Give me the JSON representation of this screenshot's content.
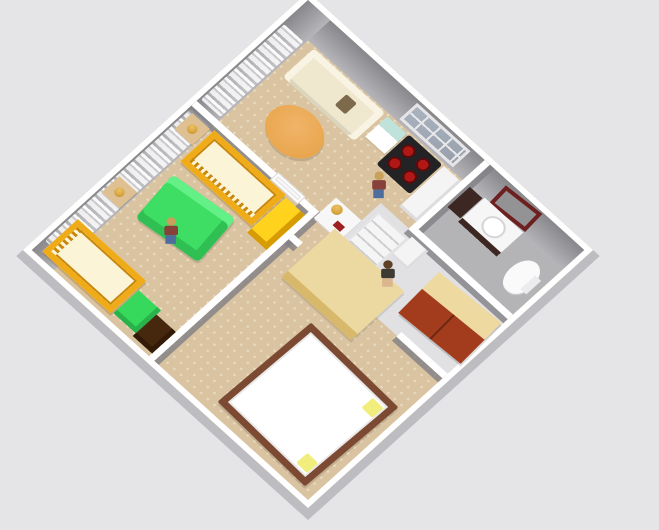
{
  "scene": {
    "type": "home-design-3d-aerial-view",
    "background_color": "#e5e4e6",
    "palette": {
      "bg": "#e5e4e6",
      "wall-white": "#ffffff",
      "wall-shadow": "#bdbcc0",
      "wall-face-dark": "#88888c",
      "wall-face-light": "#b6b6ba",
      "carpet": "#d9c3a1",
      "carpet-dot": "#e9dabd",
      "bath-floor": "#b4b4b7",
      "hall-floor": "#e1e1e3",
      "curtain-dim": "#c9c9ce",
      "window-pane": "#a9b2bf",
      "cream": "#efe8cf",
      "cream-light": "#f8f3e2",
      "cushion-brown": "#7d6a4c",
      "table-orange": "#e8a64d",
      "teal": "#bfe3da",
      "stove-black": "#232326",
      "burner-red": "#b01815",
      "counter-white": "#f4f4f5",
      "sink-dark": "#3c2723",
      "mirror-frame": "#6e2020",
      "mirror-glass": "#939396",
      "wardrobe-red": "#a23c1d",
      "wardrobe-top": "#eed9a0",
      "wardrobe-seam": "#6f2712",
      "shelf-line": "#cfcfd2",
      "crib-yellow": "#efac18",
      "crib-slat": "#c8860c",
      "mattress": "#fbf4d6",
      "dresser-yellow": "#ffd21e",
      "dresser-yellow-dark": "#d79c04",
      "sofa-green": "#3ede64",
      "sofa-green-dark": "#2fbf52",
      "sofa-green-light": "#63f087",
      "chest-green": "#36d95c",
      "dresser-brown": "#46280f",
      "bed-frame": "#7c4a33",
      "pillow-yellow": "#f2ee7d",
      "wood-light": "#ecd9a1",
      "wood-edge": "#d8b86a",
      "desk-white": "#f7f7f8",
      "book-red": "#9e2020",
      "lamp-gold": "#d8a43c",
      "skin": "#d9b68c",
      "hair-blond": "#c9a05c",
      "hair-brown": "#5f3f26",
      "shirt-maroon": "#87413a",
      "jeans": "#4d6d9e",
      "dress-dark": "#3d3b33"
    },
    "rooms": [
      {
        "id": "living-room",
        "floor": "beige-carpet"
      },
      {
        "id": "kitchen",
        "floor": "beige-carpet"
      },
      {
        "id": "bathroom",
        "floor": "gray-tile"
      },
      {
        "id": "hallway",
        "floor": "white-tile"
      },
      {
        "id": "nursery",
        "floor": "beige-carpet"
      },
      {
        "id": "bedroom",
        "floor": "beige-carpet"
      }
    ],
    "structure": [
      {
        "id": "outer-walls",
        "color": "#ffffff"
      },
      {
        "id": "curtains-living-wall",
        "color": "#ffffff"
      },
      {
        "id": "curtains-nursery-wall",
        "color": "#ffffff"
      },
      {
        "id": "kitchen-window",
        "pane_color": "#a9b2bf"
      },
      {
        "id": "interior-door",
        "color": "#ffffff"
      }
    ],
    "furniture": [
      {
        "id": "cream-sofa",
        "room": "living-room",
        "color": "#efe8cf",
        "accent_cushion": "#7d6a4c"
      },
      {
        "id": "round-coffee-table",
        "room": "living-room",
        "color": "#e8a64d"
      },
      {
        "id": "kitchen-cabinet",
        "room": "kitchen",
        "color": "#bfe3da"
      },
      {
        "id": "stove",
        "room": "kitchen",
        "color": "#232326",
        "burners": 4,
        "burner_color": "#b01815"
      },
      {
        "id": "kitchen-counter",
        "room": "kitchen",
        "color": "#f4f4f5"
      },
      {
        "id": "wall-mirror",
        "room": "bathroom",
        "frame_color": "#6e2020",
        "glass_color": "#939396"
      },
      {
        "id": "sink-vanity",
        "room": "bathroom",
        "color": "#f6f6f7",
        "base_color": "#3c2723"
      },
      {
        "id": "dark-cabinet",
        "room": "bathroom",
        "color": "#3c2723"
      },
      {
        "id": "toilet",
        "room": "bathroom",
        "color": "#fafafa"
      },
      {
        "id": "bookshelf",
        "room": "hallway",
        "color": "#f5f5f6"
      },
      {
        "id": "hall-cabinet",
        "room": "hallway",
        "color": "#ffffff"
      },
      {
        "id": "wardrobe",
        "room": "hallway",
        "color": "#a23c1d",
        "top_color": "#eed9a0"
      },
      {
        "id": "crib-top-wall",
        "room": "nursery",
        "color": "#efac18",
        "mattress_color": "#fbf4d6"
      },
      {
        "id": "crib-side-wall",
        "room": "nursery",
        "color": "#efac18",
        "mattress_color": "#fbf4d6"
      },
      {
        "id": "yellow-dresser",
        "room": "nursery",
        "color": "#ffd21e"
      },
      {
        "id": "green-sofa",
        "room": "nursery",
        "color": "#3ede64"
      },
      {
        "id": "green-chest",
        "room": "nursery",
        "color": "#36d95c"
      },
      {
        "id": "brown-dresser",
        "room": "nursery",
        "color": "#46280f"
      },
      {
        "id": "lamp-table-1",
        "room": "nursery",
        "color": "#dfc092",
        "lamp_color": "#d8a43c"
      },
      {
        "id": "lamp-table-2",
        "room": "nursery",
        "color": "#dfc092",
        "lamp_color": "#d8a43c"
      },
      {
        "id": "double-bed",
        "room": "bedroom",
        "frame_color": "#7c4a33",
        "bedding_color": "#ffffff",
        "pillow_color": "#f2ee7d"
      },
      {
        "id": "wood-table",
        "room": "bedroom",
        "color": "#ecd9a1"
      },
      {
        "id": "white-desk",
        "room": "bedroom",
        "color": "#f7f7f8",
        "lamp_color": "#d8a43c",
        "book_color": "#9e2020"
      }
    ],
    "people": [
      {
        "id": "man-nursery",
        "hair": "#c9a05c",
        "shirt": "#87413a",
        "pants": "#4d6d9e"
      },
      {
        "id": "man-kitchen",
        "hair": "#c9a05c",
        "shirt": "#87413a",
        "pants": "#4d6d9e"
      },
      {
        "id": "woman-hallway",
        "hair": "#5f3f26",
        "dress": "#3d3b33",
        "legs": "#d9b68c"
      }
    ]
  }
}
